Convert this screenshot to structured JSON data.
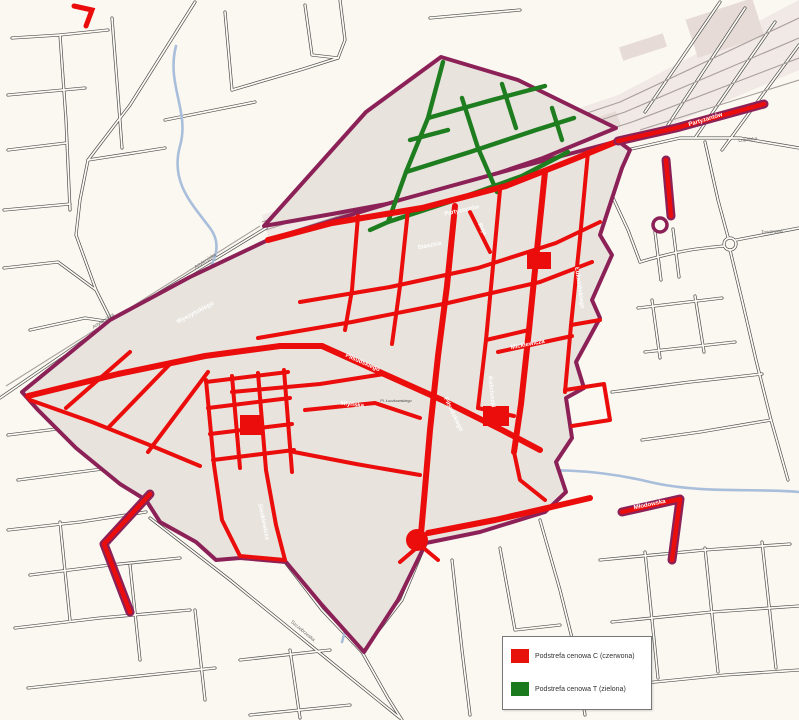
{
  "page": {
    "type": "city-paid-parking-zones-map"
  },
  "legend": {
    "items": [
      {
        "zone": "C",
        "label": "Podstrefa cenowa C (czerwona)",
        "color": "#e8120c"
      },
      {
        "zone": "T",
        "label": "Podstrefa cenowa T (zielona)",
        "color": "#1b7a1e"
      }
    ]
  },
  "colors": {
    "background": "#fbf8f1",
    "zone_fill": "#e8e3dd",
    "zone_boundary": "#8c2157",
    "red_street": "#ea0d0b",
    "green_street": "#1d7d1f",
    "river": "#a9bedb",
    "road_outline": "#4d4d4d"
  },
  "street_labels": [
    {
      "text": "Partyzantów",
      "x": 462,
      "y": 212,
      "rot": -12,
      "style": ""
    },
    {
      "text": "Partyzantów",
      "x": 706,
      "y": 121,
      "rot": -17,
      "style": ""
    },
    {
      "text": "Artyleryjska",
      "x": 206,
      "y": 262,
      "rot": -33,
      "style": "dark"
    },
    {
      "text": "Artyleryjska",
      "x": 104,
      "y": 322,
      "rot": -33,
      "style": "dark"
    },
    {
      "text": "Piłsudskiego",
      "x": 362,
      "y": 364,
      "rot": 24,
      "style": ""
    },
    {
      "text": "Piłsudskiego",
      "x": 452,
      "y": 415,
      "rot": 64,
      "style": ""
    },
    {
      "text": "Mickiewicza",
      "x": 528,
      "y": 346,
      "rot": -11,
      "style": ""
    },
    {
      "text": "Staszica",
      "x": 430,
      "y": 247,
      "rot": -12,
      "style": ""
    },
    {
      "text": "Reja",
      "x": 481,
      "y": 230,
      "rot": 62,
      "style": ""
    },
    {
      "text": "Kościuszki",
      "x": 490,
      "y": 392,
      "rot": 84,
      "style": ""
    },
    {
      "text": "Wyszyńskiego",
      "x": 196,
      "y": 314,
      "rot": -28,
      "style": ""
    },
    {
      "text": "Młyńska",
      "x": 352,
      "y": 406,
      "rot": 6,
      "style": ""
    },
    {
      "text": "Pl. Łuczkowskiego",
      "x": 396,
      "y": 402,
      "rot": 0,
      "style": "tiny"
    },
    {
      "text": "Lubelska",
      "x": 748,
      "y": 141,
      "rot": -6,
      "style": "dark"
    },
    {
      "text": "Towarowa",
      "x": 772,
      "y": 233,
      "rot": -4,
      "style": "dark"
    },
    {
      "text": "Sienkiewicza",
      "x": 262,
      "y": 522,
      "rot": 78,
      "style": ""
    },
    {
      "text": "Młodowska",
      "x": 650,
      "y": 506,
      "rot": -12,
      "style": ""
    },
    {
      "text": "Łukasińskiego",
      "x": 578,
      "y": 288,
      "rot": 82,
      "style": ""
    },
    {
      "text": "Szczebrzeska",
      "x": 302,
      "y": 632,
      "rot": 40,
      "style": "dark"
    }
  ]
}
